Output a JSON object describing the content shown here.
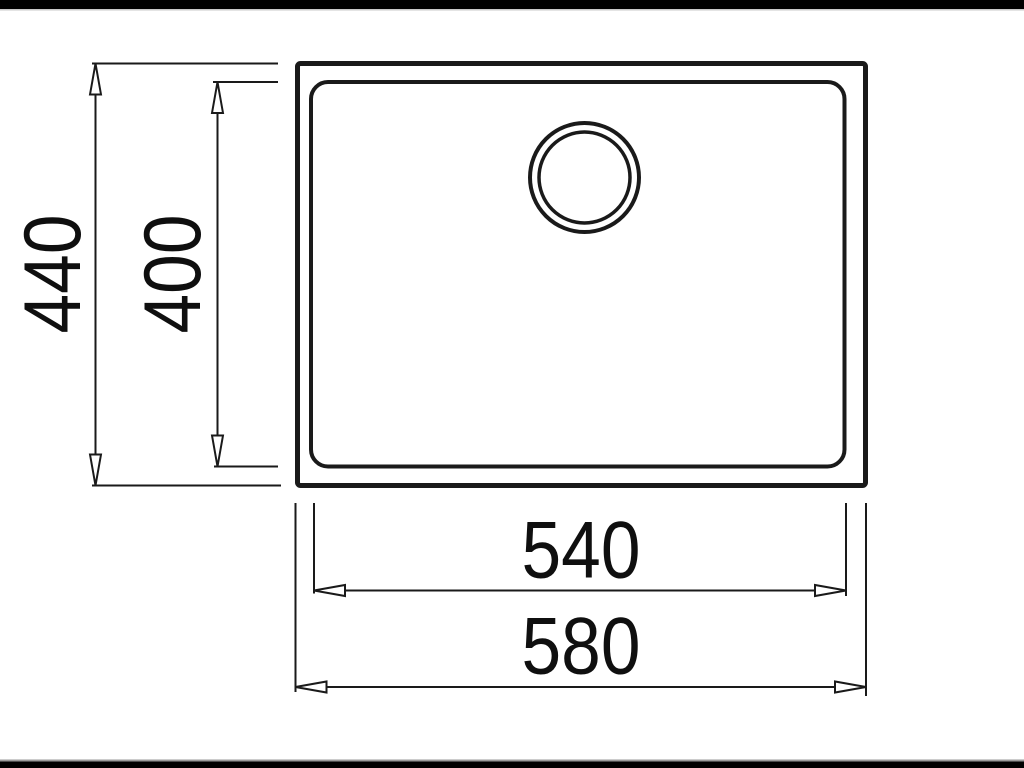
{
  "figure": {
    "type": "technical-dimension-drawing",
    "view": "sink-top-view",
    "labels": {
      "outer_height": "440",
      "inner_height": "400",
      "inner_width": "540",
      "outer_width": "580"
    }
  },
  "colors": {
    "background": "#ffffff",
    "line": "#1a1a1a",
    "text": "#0f0f0f",
    "letterbox": "#000000"
  }
}
